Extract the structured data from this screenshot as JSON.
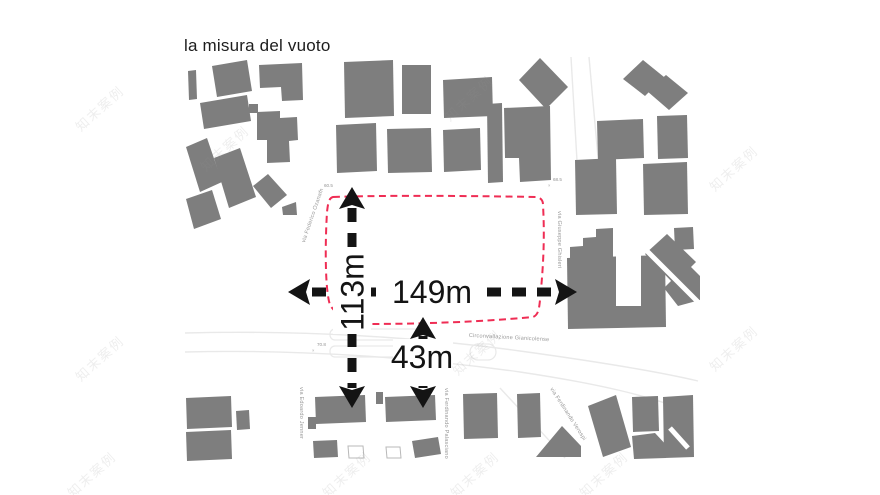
{
  "title": "la misura del vuoto",
  "watermark": {
    "text": "知末案例"
  },
  "colors": {
    "background": "#ffffff",
    "building": "#7e7e7e",
    "void_outline": "#ef2d54",
    "dimension": "#141414",
    "street_label": "#9a9a9a",
    "street_line": "#e9e9e9"
  },
  "dimensions": {
    "width": {
      "label": "149m",
      "orientation": "horizontal"
    },
    "height": {
      "label": "113m",
      "orientation": "vertical"
    },
    "offset": {
      "label": "43m",
      "orientation": "vertical"
    }
  },
  "streets": [
    {
      "name": "via Federico Ozanam"
    },
    {
      "name": "via Giuseppe Ghisleri"
    },
    {
      "name": "Circonvallazione Gianicolense"
    },
    {
      "name": "via Edoardo Jenner"
    },
    {
      "name": "via Ferdinando Palasciano"
    },
    {
      "name": "via Ferdinando Verospi"
    }
  ],
  "spot_elevations": [
    "60.5",
    "68.5",
    "70.8"
  ],
  "spot_marker": "×"
}
